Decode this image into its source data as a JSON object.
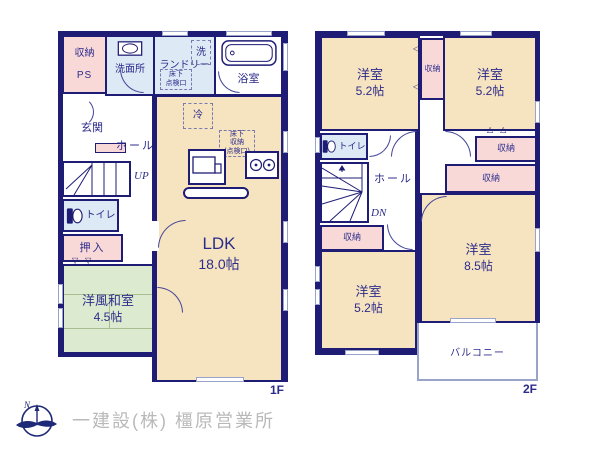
{
  "colors": {
    "wall": "#1e1c74",
    "text": "#2c2c8c",
    "room_beige": "#f6e3bf",
    "closet_pink": "#f8d9d8",
    "wet_blue": "#dde9f4",
    "tatami_green": "#dcebcf",
    "balcony_border": "#9aa3c8",
    "company_text": "#b9b9b9"
  },
  "floor1": {
    "floor_label": "1F",
    "storage": "収納",
    "ps": "PS",
    "washroom": "洗面所",
    "laundry": "ランドリー",
    "washer": "洗",
    "hatch_l1": "床下",
    "hatch_l2": "点検口",
    "bathroom": "浴室",
    "genkan": "玄関",
    "hall": "ホール",
    "up": "UP",
    "toilet": "トイレ",
    "oshiire": "押入",
    "wafu_name": "洋風和室",
    "wafu_size": "4.5帖",
    "fridge": "冷",
    "ufs_l1": "床下",
    "ufs_l2": "収納",
    "ufs_l3": "(点検口)",
    "ldk_name": "LDK",
    "ldk_size": "18.0帖"
  },
  "floor2": {
    "floor_label": "2F",
    "room_tl_name": "洋室",
    "room_tl_size": "5.2帖",
    "room_tr_name": "洋室",
    "room_tr_size": "5.2帖",
    "room_br_name": "洋室",
    "room_br_size": "8.5帖",
    "room_bl_name": "洋室",
    "room_bl_size": "5.2帖",
    "closet": "収納",
    "toilet": "トイレ",
    "hall": "ホール",
    "dn": "DN",
    "balcony": "バルコニー"
  },
  "footer": {
    "company": "一建設(株) 橿原営業所",
    "compass_n": "N"
  }
}
